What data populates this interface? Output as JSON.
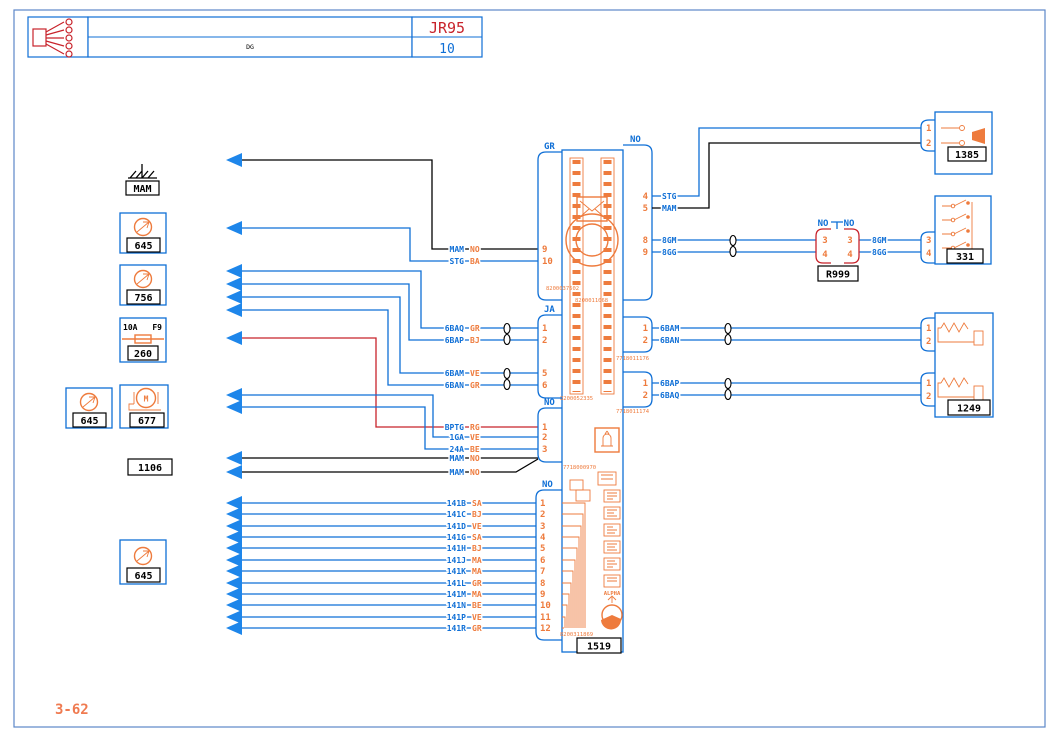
{
  "colors": {
    "wire_blue": "#0f6fd6",
    "component_orange": "#ee7b3d",
    "alert_red": "#c8232b",
    "wire_black": "#000000",
    "page_border_blue": "#5c87c9",
    "arrow_blue": "#1e86ea"
  },
  "header": {
    "code": "DG",
    "ref": "JR95",
    "sheet": "10"
  },
  "footer": {
    "page_ref": "3-62"
  },
  "ground": {
    "label": "MAM"
  },
  "left_column": {
    "splice_a": "645",
    "splice_b": "756",
    "fuse": {
      "rating": "10A",
      "slot": "F9",
      "label": "260"
    },
    "splice_c": "645",
    "motor": {
      "symbol": "M",
      "label": "677"
    },
    "tag": "1106",
    "splice_d": "645"
  },
  "module": {
    "label": "1519",
    "brand": "ALPHA",
    "part_numbers": {
      "pn1": "8200037602",
      "pn2": "8200011068",
      "pn3": "8200052335",
      "pn4": "7718011176",
      "pn5": "7718011174",
      "pn6": "7718000970",
      "pn7": "8200311869"
    },
    "conn_gr": {
      "label": "GR",
      "pins": [
        "9",
        "10"
      ]
    },
    "conn_ja": {
      "label": "JA",
      "pins": [
        "1",
        "2",
        "5",
        "6"
      ]
    },
    "conn_no_mid": {
      "label": "NO",
      "pins": [
        "1",
        "2",
        "3"
      ]
    },
    "conn_no_bot": {
      "label": "NO",
      "pins": [
        "1",
        "2",
        "3",
        "4",
        "5",
        "6",
        "7",
        "8",
        "9",
        "10",
        "11",
        "12"
      ]
    },
    "conn_no_right": {
      "label": "NO",
      "pins": [
        "4",
        "5",
        "8",
        "9"
      ]
    },
    "conn_right_1": {
      "pins": [
        "1",
        "2"
      ]
    },
    "conn_right_2": {
      "pins": [
        "1",
        "2"
      ]
    }
  },
  "wires": {
    "gr": [
      {
        "name": "MAM",
        "code": "NO"
      },
      {
        "name": "STG",
        "code": "BA"
      }
    ],
    "ja": [
      {
        "name": "6BAQ",
        "code": "GR"
      },
      {
        "name": "6BAP",
        "code": "BJ"
      },
      {
        "name": "6BAM",
        "code": "VE"
      },
      {
        "name": "6BAN",
        "code": "GR"
      }
    ],
    "no_mid": [
      {
        "name": "BPTG",
        "code": "RG"
      },
      {
        "name": "1GA",
        "code": "VE"
      },
      {
        "name": "24A",
        "code": "BE"
      },
      {
        "name": "MAM",
        "code": "NO"
      },
      {
        "name": "MAM",
        "code": "NO"
      }
    ],
    "bottom": [
      {
        "name": "141B",
        "code": "SA"
      },
      {
        "name": "141C",
        "code": "BJ"
      },
      {
        "name": "141D",
        "code": "VE"
      },
      {
        "name": "141G",
        "code": "SA"
      },
      {
        "name": "141H",
        "code": "BJ"
      },
      {
        "name": "141J",
        "code": "MA"
      },
      {
        "name": "141K",
        "code": "MA"
      },
      {
        "name": "141L",
        "code": "GR"
      },
      {
        "name": "141M",
        "code": "MA"
      },
      {
        "name": "141N",
        "code": "BE"
      },
      {
        "name": "141P",
        "code": "VE"
      },
      {
        "name": "141R",
        "code": "GR"
      }
    ],
    "right_top": {
      "stg": "STG",
      "mam": "MAM",
      "gm": "8GM",
      "gg": "8GG",
      "gm2": "8GM",
      "gg2": "8GG"
    },
    "right_1": [
      "6BAM",
      "6BAN"
    ],
    "right_2": [
      "6BAP",
      "6BAQ"
    ]
  },
  "right_components": {
    "horn": {
      "label": "1385",
      "pins": [
        "1",
        "2"
      ]
    },
    "inline": {
      "label": "R999",
      "tag_left": "NO",
      "tag_right": "NO",
      "pins_left": [
        "3",
        "4"
      ],
      "pins_right": [
        "3",
        "4"
      ]
    },
    "switches": {
      "label": "331",
      "pins": [
        "3",
        "4"
      ]
    },
    "resistors": {
      "label": "1249",
      "pins_top": [
        "1",
        "2"
      ],
      "pins_bot": [
        "1",
        "2"
      ]
    }
  }
}
